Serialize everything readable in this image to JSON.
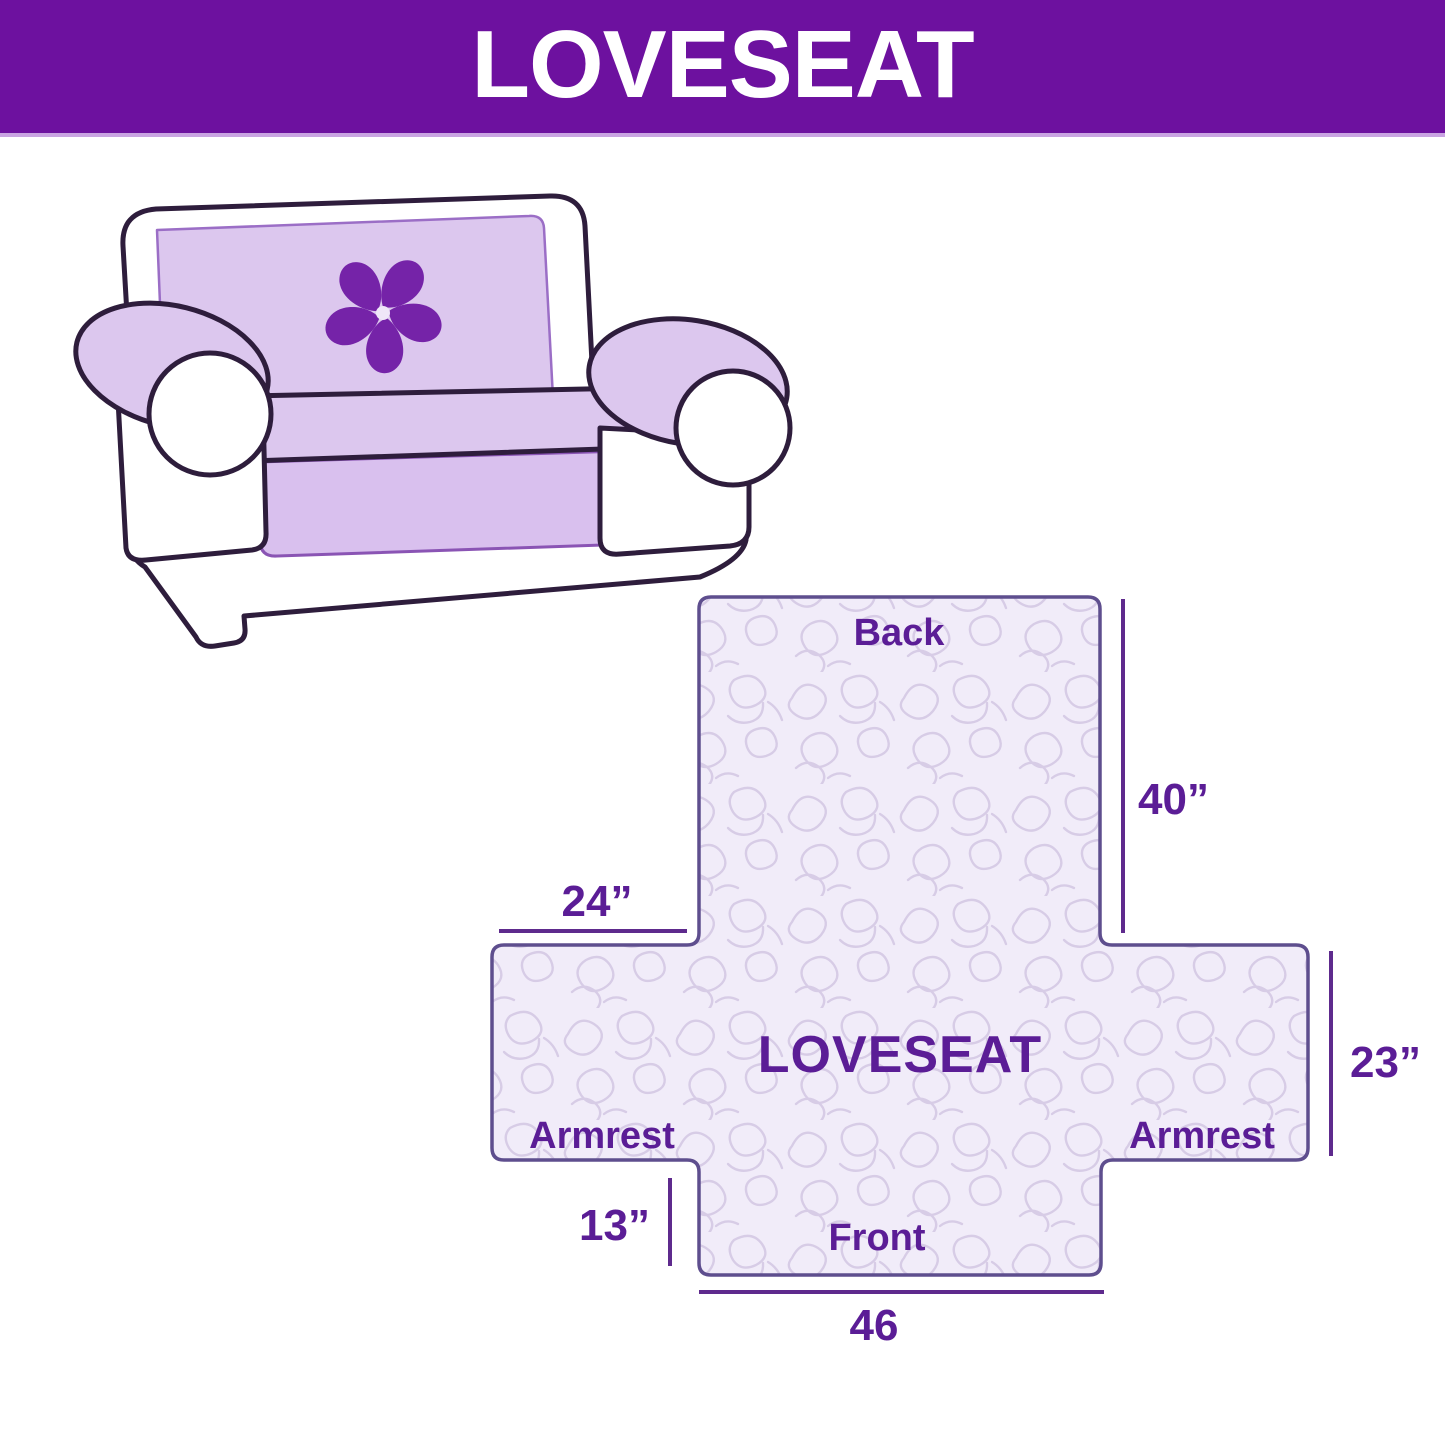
{
  "header": {
    "title": "LOVESEAT"
  },
  "illustration": {
    "alt": "Line drawing of a loveseat sofa fitted with a lavender quilted furniture cover",
    "logo_icon": "pinwheel-flower"
  },
  "diagram": {
    "center_label": "LOVESEAT",
    "back_label": "Back",
    "front_label": "Front",
    "armrest_left_label": "Armrest",
    "armrest_right_label": "Armrest",
    "dim_back_height": "40”",
    "dim_armrest_width": "24”",
    "dim_side_height": "23”",
    "dim_front_height": "13”",
    "dim_front_width": "46"
  },
  "colors": {
    "banner_bg": "#6d119f",
    "banner_text": "#ffffff",
    "banner_edge": "#c9a4e2",
    "label_purple": "#5b1d96",
    "dimension_line": "#5e2a8d",
    "shape_outline": "#5e4e8e",
    "shape_fill": "#f1ecf9",
    "quilt_pattern": "#d7cce6",
    "cover_lavender": "#dcc7ee",
    "skirt_lavender": "#d9c0ee",
    "sofa_outline": "#2e1d3c",
    "flower": "#7523a8"
  }
}
